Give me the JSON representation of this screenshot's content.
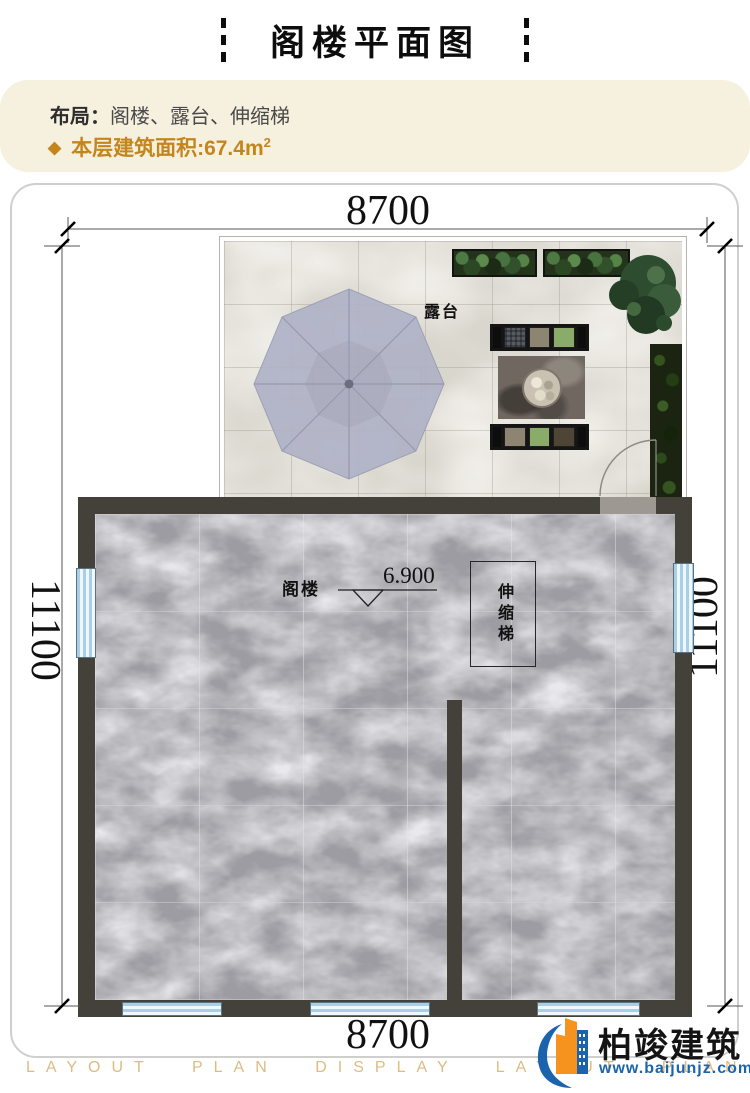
{
  "header": {
    "title": "阁楼平面图"
  },
  "info": {
    "layout_label": "布局：",
    "layout_value": "阁楼、露台、伸缩梯",
    "diamond_icon": "◆",
    "area_label": "本层建筑面积:67.4m",
    "area_superscript": "2"
  },
  "plan": {
    "dim_top": "8700",
    "dim_bottom": "8700",
    "dim_left": "11100",
    "dim_right": "11100",
    "terrace_label": "露台",
    "attic_label": "阁楼",
    "elevation_label": "6.900",
    "ladder_label": "伸缩梯"
  },
  "footer": {
    "watermark": "LAYOUT PLAN DISPLAY LAYOUT PLAN DISPLAY",
    "brand_name": "柏竣建筑",
    "brand_url": "www.baijunjz.com"
  },
  "colors": {
    "accent_gold": "#c4861c",
    "info_bg": "#f6f0df",
    "wall": "#44413a",
    "marble_floor": "#9c9ca2",
    "terrace_stone": "#d9d6cd",
    "umbrella": "#b0b3c7",
    "window_blue": "#bddcef",
    "watermark_gold": "#dcbc82",
    "brand_blue": "#1b64ad",
    "brand_orange": "#f6921e"
  }
}
